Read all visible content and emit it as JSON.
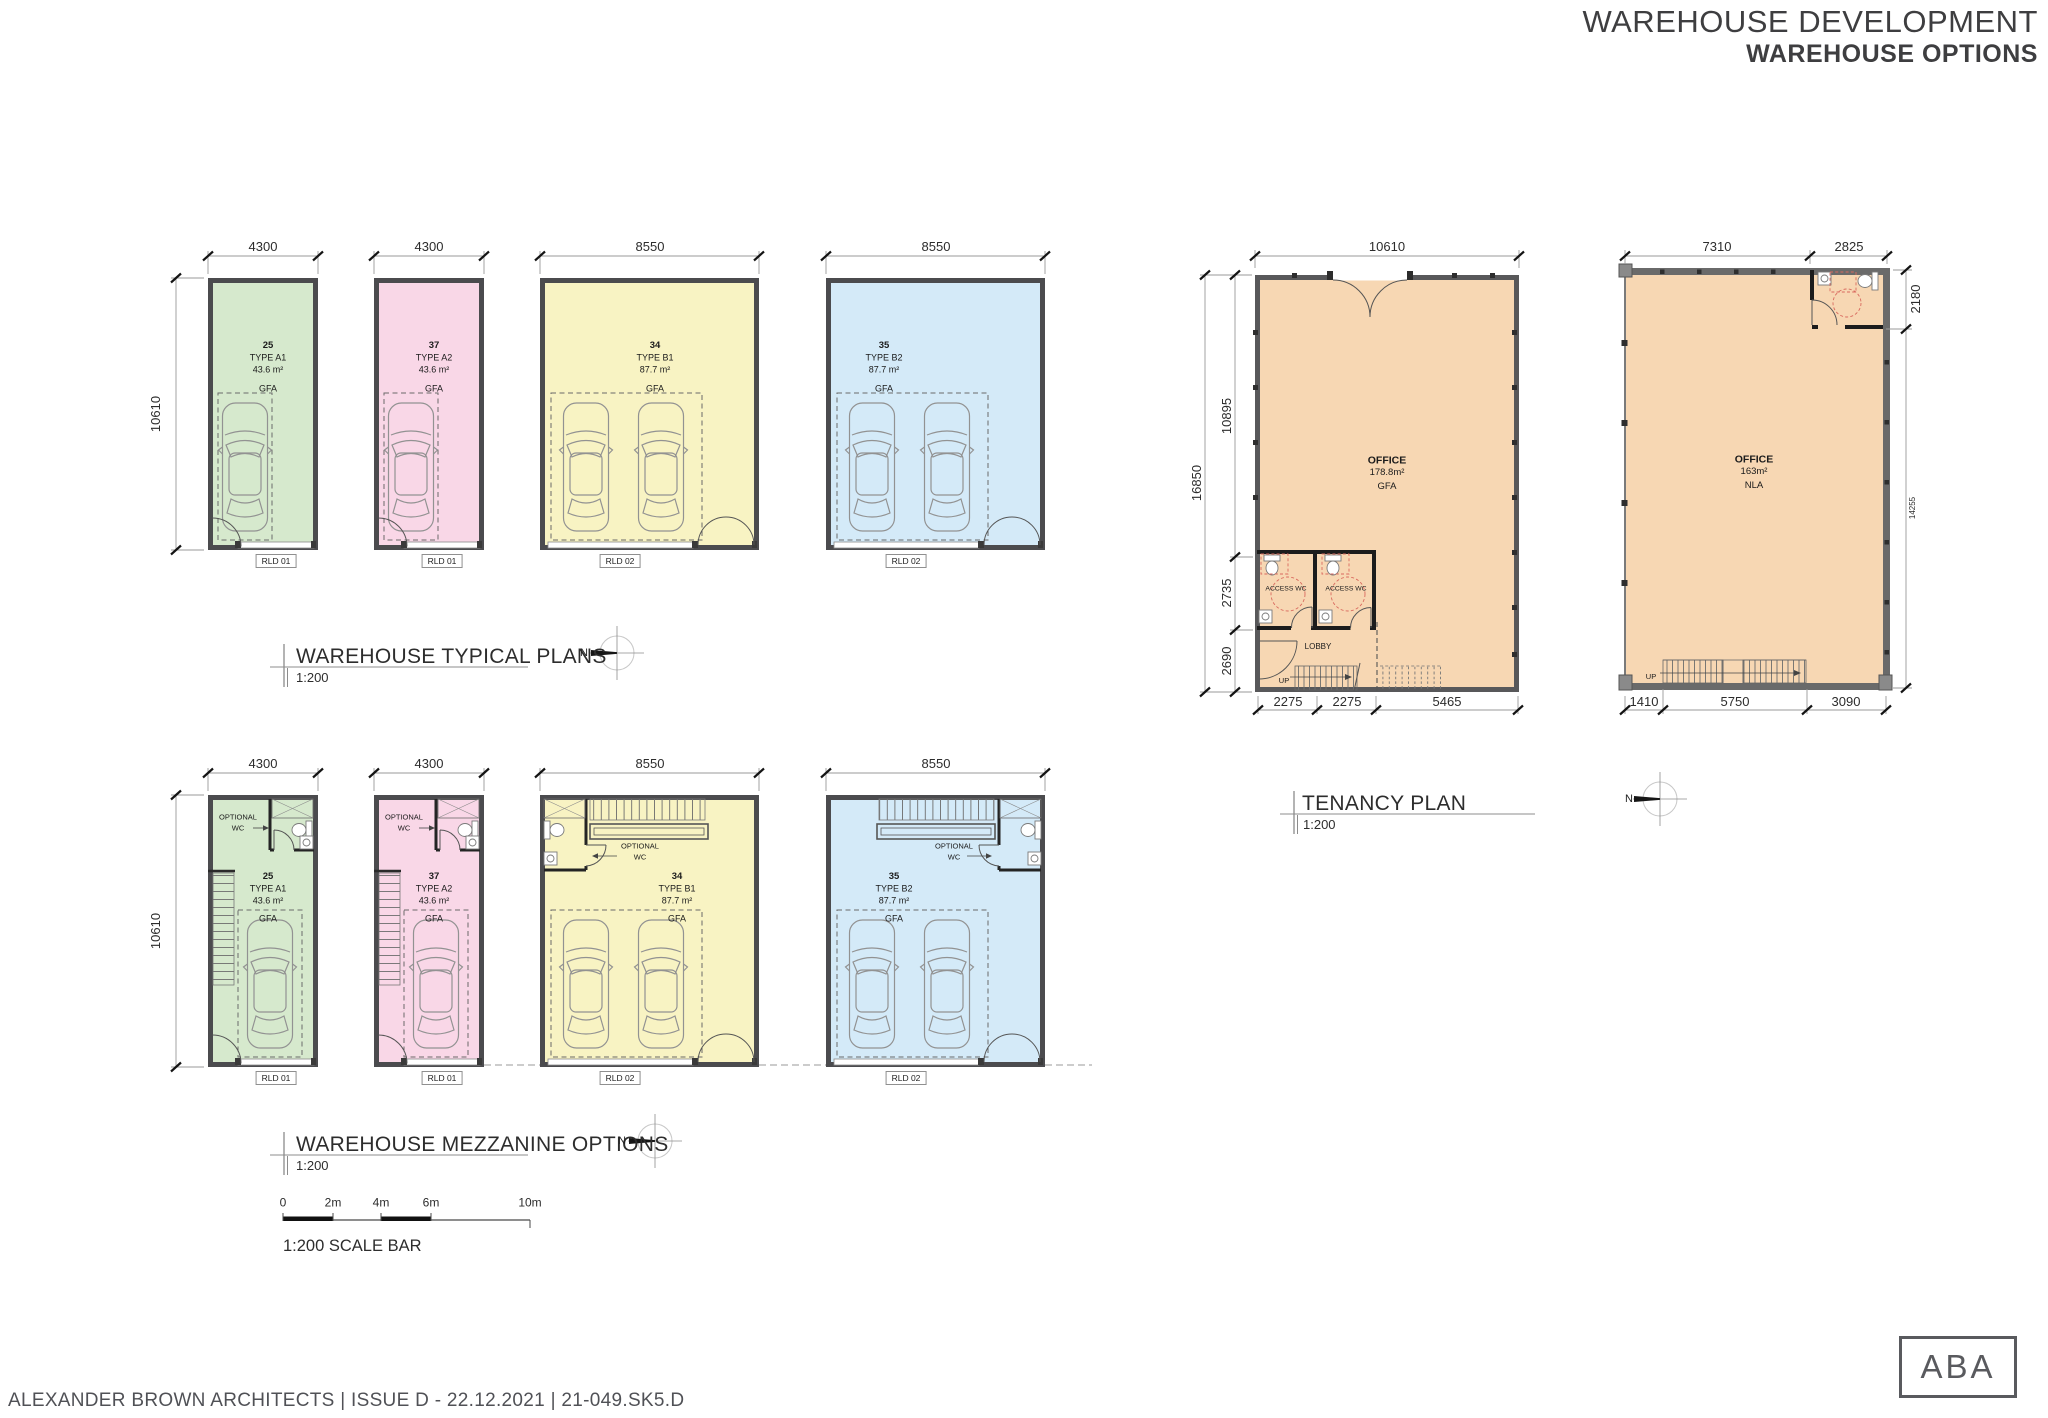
{
  "header": {
    "line1": "WAREHOUSE DEVELOPMENT",
    "line2": "WAREHOUSE OPTIONS"
  },
  "titles": {
    "typical": {
      "title": "WAREHOUSE TYPICAL PLANS",
      "scale": "1:200"
    },
    "mezzanine": {
      "title": "WAREHOUSE MEZZANINE OPTIONS",
      "scale": "1:200"
    },
    "tenancy": {
      "title": "TENANCY PLAN",
      "scale": "1:200"
    }
  },
  "north": "N",
  "scalebar": {
    "t0": "0",
    "t1": "2m",
    "t2": "4m",
    "t3": "6m",
    "t4": "10m",
    "label": "1:200 SCALE BAR"
  },
  "units": {
    "a1": {
      "number": "25",
      "type": "TYPE A1",
      "area": "43.6 m²",
      "metric": "GFA",
      "rld": "RLD 01",
      "width": "4300",
      "height": "10610",
      "optional": "OPTIONAL\nWC"
    },
    "a2": {
      "number": "37",
      "type": "TYPE A2",
      "area": "43.6 m²",
      "metric": "GFA",
      "rld": "RLD 01",
      "width": "4300",
      "optional": "OPTIONAL\nWC"
    },
    "b1": {
      "number": "34",
      "type": "TYPE B1",
      "area": "87.7 m²",
      "metric": "GFA",
      "rld": "RLD 02",
      "width": "8550",
      "optional": "OPTIONAL\nWC"
    },
    "b2": {
      "number": "35",
      "type": "TYPE B2",
      "area": "87.7 m²",
      "metric": "GFA",
      "rld": "RLD 02",
      "width": "8550",
      "optional": "OPTIONAL\nWC"
    }
  },
  "tenancy1": {
    "top": "10610",
    "total": "16850",
    "seg1": "10895",
    "seg2": "2735",
    "seg3": "2690",
    "office": "OFFICE",
    "area": "178.8m²",
    "metric": "GFA",
    "wc1": "ACCESS WC",
    "wc2": "ACCESS WC",
    "lobby": "LOBBY",
    "up": "UP",
    "b1": "2275",
    "b2": "2275",
    "b3": "5465"
  },
  "tenancy2": {
    "d1": "7310",
    "d2": "2825",
    "r1": "2180",
    "r2": "14255",
    "office": "OFFICE",
    "area": "163m²",
    "metric": "NLA",
    "up": "UP",
    "b1": "1410",
    "b2": "5750",
    "b3": "3090"
  },
  "footer": "ALEXANDER BROWN ARCHITECTS | ISSUE D - 22.12.2021 | 21-049.SK5.D",
  "logo": "ABA"
}
